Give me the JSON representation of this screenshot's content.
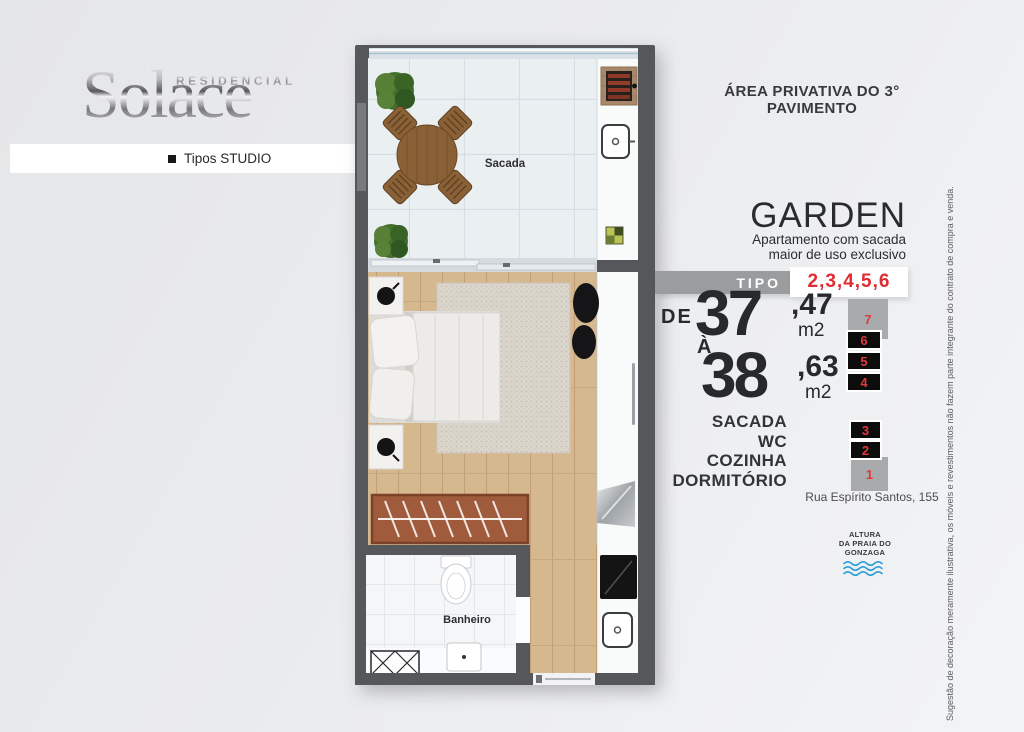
{
  "logo": {
    "brand_top": "RESIDENCIAL",
    "brand": "Solace"
  },
  "band": {
    "label": "Tipos STUDIO"
  },
  "header": {
    "title": "ÁREA PRIVATIVA DO 3° PAVIMENTO"
  },
  "plan": {
    "sacada_label": "Sacada",
    "banheiro_label": "Banheiro"
  },
  "garden": {
    "title": "GARDEN",
    "subtitle_line1": "Apartamento com sacada",
    "subtitle_line2": "maior de uso exclusivo"
  },
  "tipo": {
    "label": "TIPO",
    "values": "2,3,4,5,6"
  },
  "area": {
    "from_prefix": "DE",
    "from_int": "37",
    "from_dec": ",47",
    "from_unit": "m2",
    "to_prefix": "À",
    "to_int": "38",
    "to_dec": ",63",
    "to_unit": "m2"
  },
  "rooms": [
    "SACADA",
    "WC",
    "COZINHA",
    "DORMITÓRIO"
  ],
  "building": {
    "floors": [
      {
        "label": "7",
        "style": "gray"
      },
      {
        "label": "6",
        "style": "black"
      },
      {
        "label": "5",
        "style": "black"
      },
      {
        "label": "4",
        "style": "black"
      },
      {
        "label": "3",
        "style": "black"
      },
      {
        "label": "2",
        "style": "black"
      },
      {
        "label": "1",
        "style": "gray"
      }
    ]
  },
  "address": "Rua Espírito Santos, 155",
  "beach": {
    "line1": "ALTURA",
    "line2": "DA PRAIA DO",
    "line3": "GONZAGA"
  },
  "disclaimer": "Sugestão de decoração meramente ilustrativa, os móveis e revestimentos não fazem parte integrante do contrato de compra e venda.",
  "colors": {
    "accent_red": "#e02b30",
    "wall_gray": "#56575b",
    "tipo_bar_gray": "#9b9c9e",
    "wave_blue": "#2da0d8",
    "wood": "#d6b88f"
  }
}
